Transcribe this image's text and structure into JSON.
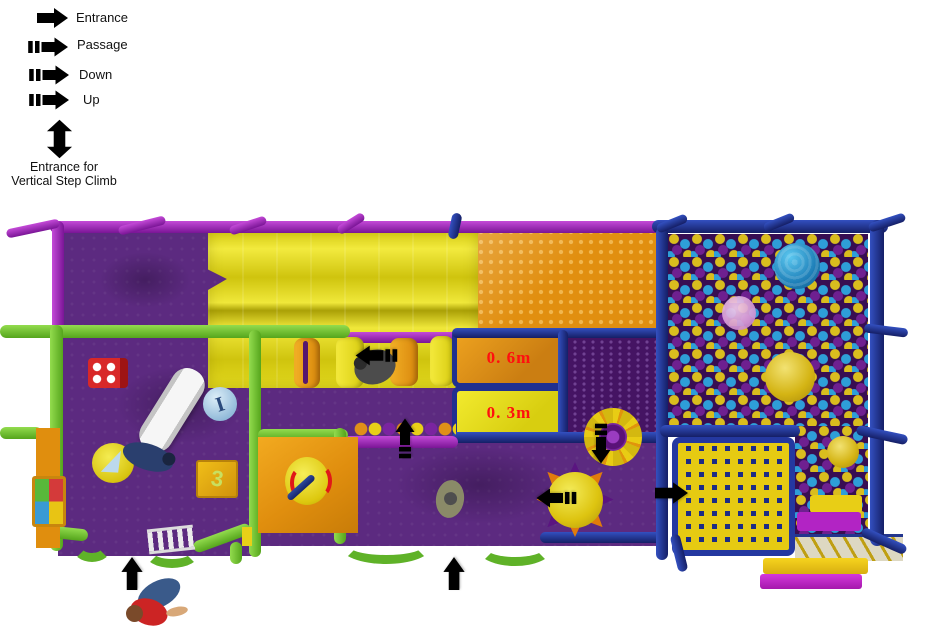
{
  "legend": {
    "items": [
      {
        "label": "Entrance"
      },
      {
        "label": "Passage"
      },
      {
        "label": "Down"
      },
      {
        "label": "Up"
      }
    ],
    "vertical_step_climb": {
      "line1": "Entrance for",
      "line2": "Vertical Step Climb"
    }
  },
  "playfield": {
    "height_labels": [
      {
        "text": "0. 6m"
      },
      {
        "text": "0. 3m"
      }
    ],
    "toy_cube_digit": "3",
    "toy_disc_letter": "I"
  },
  "colors": {
    "entrance_arrow_red": "#ee1c25",
    "passage_arrow_white": "#ffffff",
    "down_arrow_yellow": "#f6e316",
    "floor_purple": "#5c2a80",
    "frame_green": "#6cc12f",
    "frame_purple": "#9b27b5",
    "frame_navy": "#1e2f8a",
    "mesh_orange": "#e18f10",
    "slide_yellow": "#e8dc1c",
    "height_label_red": "#ff0f0f",
    "ball_colors": [
      "#d9bd1e",
      "#2e9ed8",
      "#6e2090"
    ]
  }
}
